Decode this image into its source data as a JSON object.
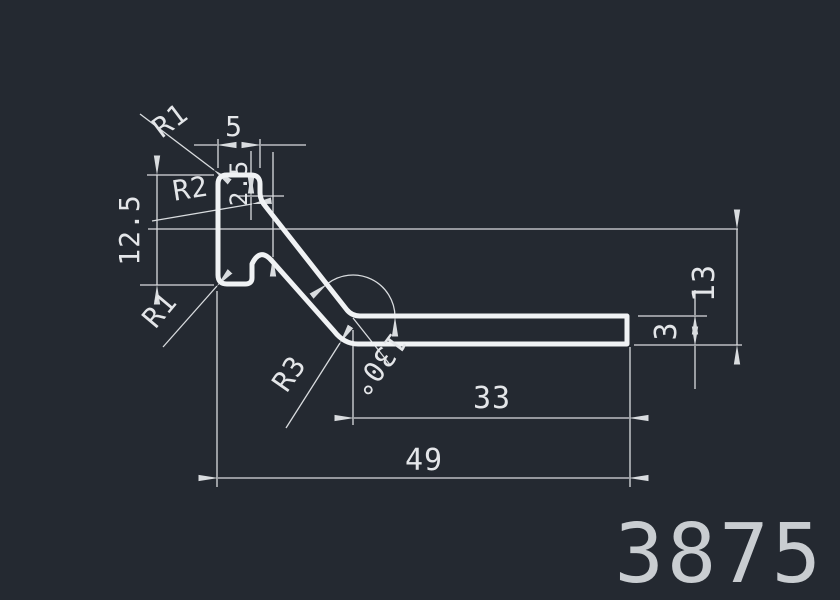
{
  "drawing": {
    "part_number": "3875",
    "dimensions": {
      "top_width": "5",
      "flange_step": "2.5",
      "left_height": "12.5",
      "right_height": "13",
      "strip_thickness": "3",
      "strip_length": "33",
      "overall_width": "49",
      "bend_angle": "130°",
      "radius_top_left": "R1",
      "radius_bottom_left": "R1",
      "radius_web_root": "R2",
      "radius_bend": "R3"
    },
    "colors": {
      "background": "#242931",
      "profile_line": "#f0f2f4",
      "dimension_line": "#d9dcdf",
      "text": "#e4e6e9",
      "part_number": "#c9cdd1"
    }
  }
}
